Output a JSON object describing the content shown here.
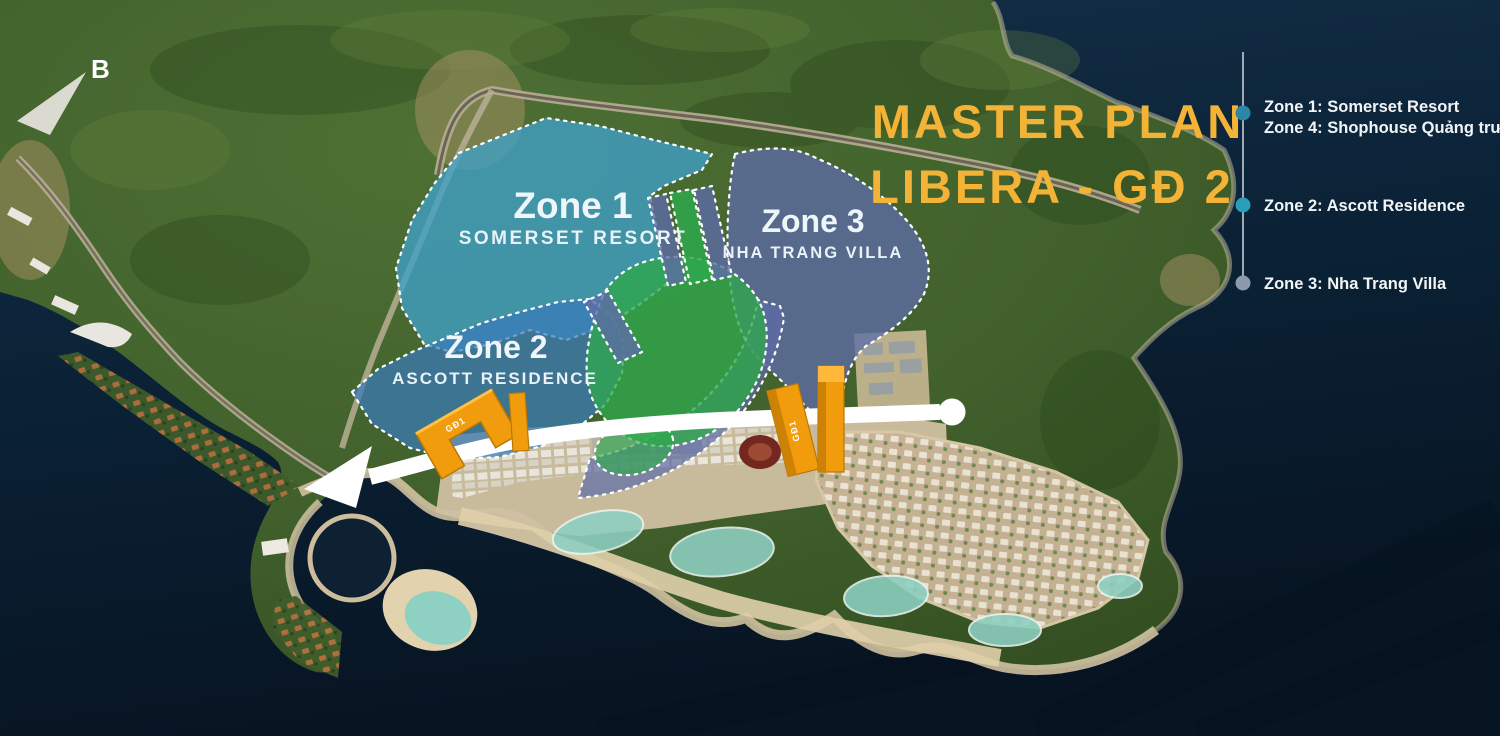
{
  "title": {
    "line1": "MASTER PLAN",
    "line2": "LIBERA - GĐ 2",
    "color": "#f2b337"
  },
  "compass": {
    "label": "B"
  },
  "zone_labels": {
    "zone1": {
      "title": "Zone 1",
      "subtitle": "SOMERSET RESORT",
      "fill": "#3fa0c8"
    },
    "zone2": {
      "title": "Zone 2",
      "subtitle": "ASCOTT RESIDENCE",
      "fill": "#3a7ab8"
    },
    "zone3": {
      "title": "Zone 3",
      "subtitle": "NHA TRANG VILLA",
      "fill": "#5d6ba6"
    },
    "park_fill": "#2ea84c"
  },
  "legend": {
    "items": [
      {
        "bullet_color": "#2e86a6",
        "lines": [
          "Zone 1: Somerset Resort",
          "Zone 4: Shophouse Quảng trường"
        ]
      },
      {
        "bullet_color": "#2a9cbc",
        "lines": [
          "Zone 2: Ascott Residence"
        ]
      },
      {
        "bullet_color": "#8d99ac",
        "lines": [
          "Zone 3: Nha Trang Villa"
        ]
      }
    ]
  },
  "phase_buildings": {
    "label": "GĐ1",
    "color": "#f09c0c"
  }
}
